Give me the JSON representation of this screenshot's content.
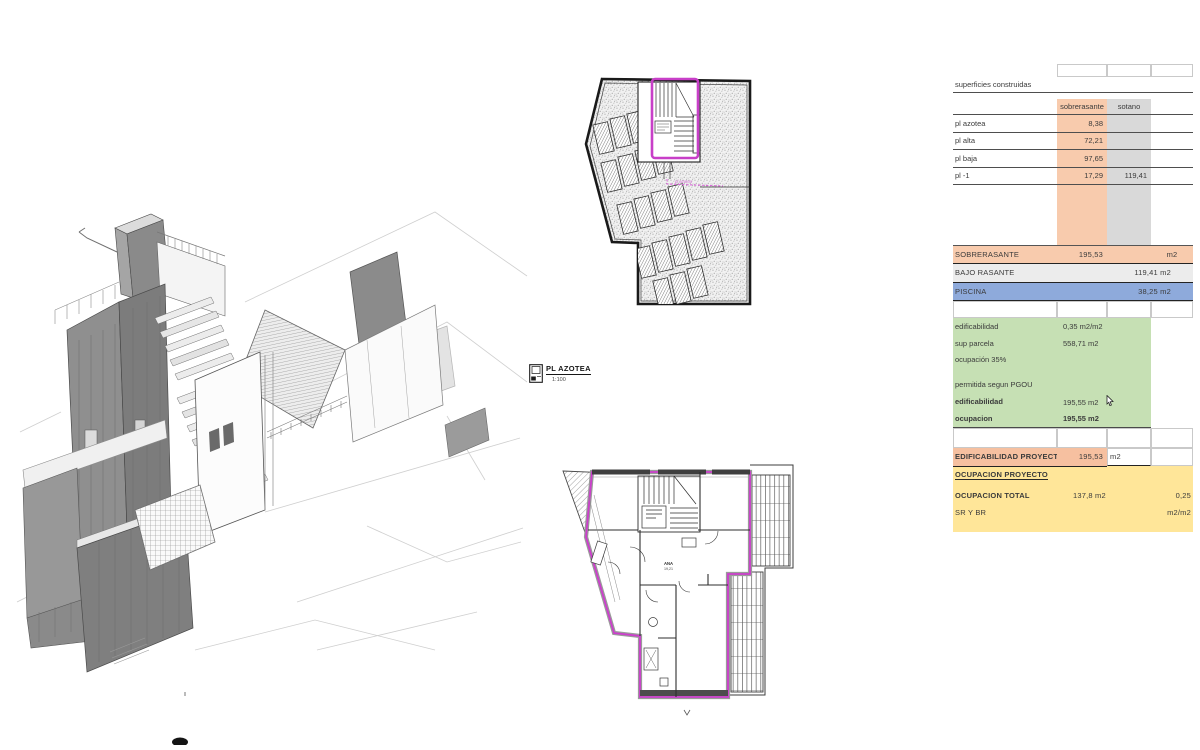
{
  "legend": {
    "title": "PL AZOTEA",
    "scale": "1:100"
  },
  "roof_plan": {
    "annotation": "pl azotea"
  },
  "floor_plan": {
    "room_label": "ANA",
    "room_area": "19,21"
  },
  "table": {
    "title": "superficies construidas",
    "columns": {
      "sobre": "sobrerasante",
      "sotano": "sotano"
    },
    "floors": [
      {
        "label": "pl azotea",
        "sobre": "8,38",
        "sotano": ""
      },
      {
        "label": "pl alta",
        "sobre": "72,21",
        "sotano": ""
      },
      {
        "label": "pl baja",
        "sobre": "97,65",
        "sotano": ""
      },
      {
        "label": "pl -1",
        "sobre": "17,29",
        "sotano": "119,41"
      }
    ],
    "totals": {
      "sobrerasante": {
        "label": "SOBRERASANTE",
        "value": "195,53",
        "unit": "m2"
      },
      "bajo_rasante": {
        "label": "BAJO RASANTE",
        "value": "119,41 m2"
      },
      "piscina": {
        "label": "PISCINA",
        "value": "38,25 m2"
      }
    },
    "normativa": {
      "edificabilidad": {
        "label": "edificabilidad",
        "value": "0,35 m2/m2"
      },
      "sup_parcela": {
        "label": "sup parcela",
        "value": "558,71 m2"
      },
      "ocupacion_pct": {
        "label": "ocupación 35%"
      },
      "permitida": {
        "label": "permitida segun PGOU"
      },
      "edificabilidad_permitida": {
        "label": "edificabilidad",
        "value": "195,55 m2"
      },
      "ocupacion_permitida": {
        "label": "ocupacion",
        "value": "195,55 m2"
      }
    },
    "proyecto": {
      "edificabilidad": {
        "label": "EDIFICABILIDAD PROYECTO",
        "value": "195,53",
        "unit": "m2"
      },
      "ocupacion": {
        "label": "OCUPACION PROYECTO"
      },
      "ocupacion_total": {
        "label": "OCUPACION TOTAL",
        "value": "137,8 m2",
        "ratio": "0,25"
      },
      "sr_br": {
        "label": "SR Y BR",
        "unit": "m2/m2"
      }
    }
  },
  "colors": {
    "accent_magenta": "#cc3ecc",
    "salmon": "#f8cbad",
    "gray": "#d9d9d9",
    "blue": "#8eaadb",
    "green": "#c6e0b4",
    "yellow": "#ffe699"
  }
}
